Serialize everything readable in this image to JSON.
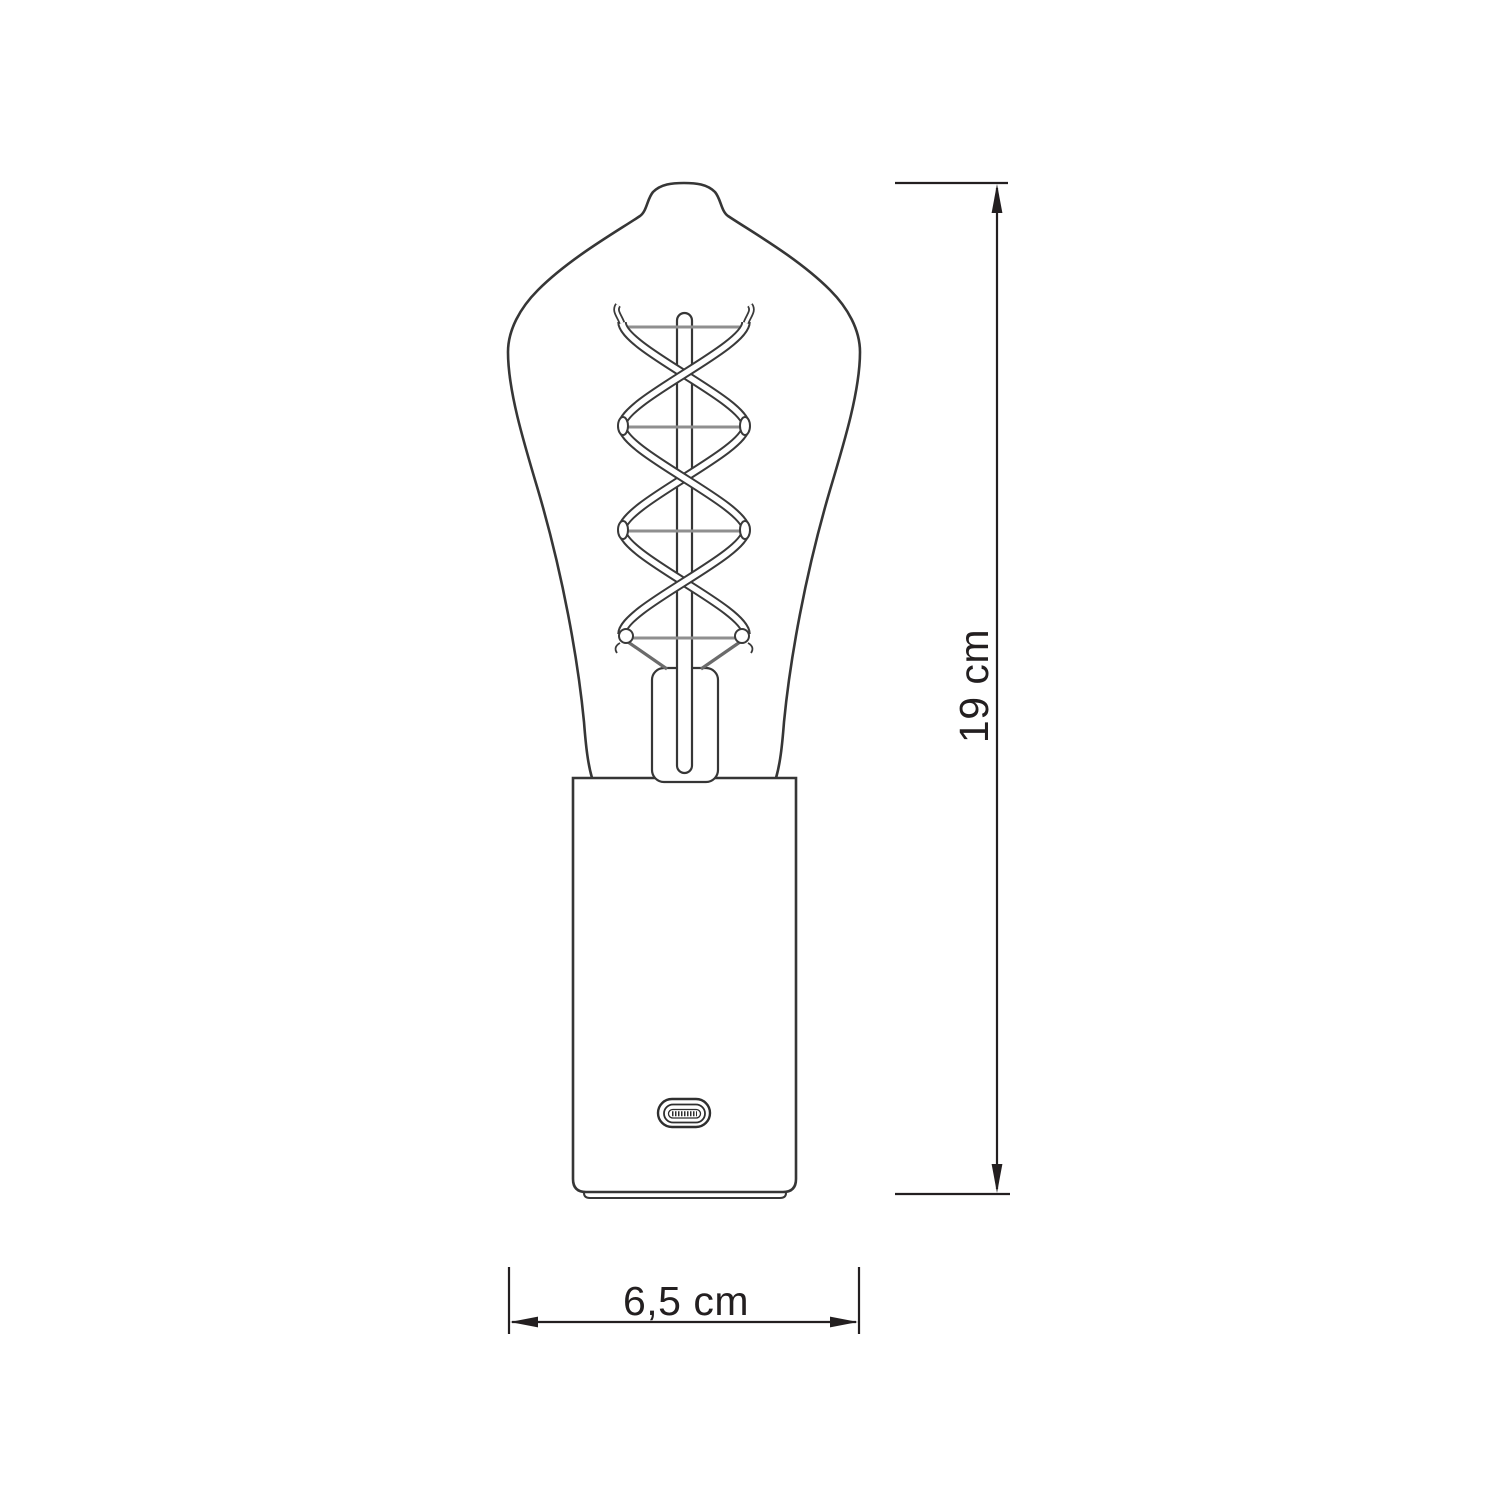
{
  "diagram": {
    "type": "technical-dimension-drawing",
    "subject": "edison-st64-filament-bulb-lamp-with-usb-c-base",
    "dimensions": {
      "height_label": "19 cm",
      "width_label": "6,5 cm"
    },
    "colors": {
      "background": "#ffffff",
      "line": "#363636",
      "filament_outline": "#3a3a3a",
      "support_wire": "#8f8f8f",
      "lead_wire": "#6b6b6b",
      "dimension": "#231f20",
      "text": "#231f20"
    }
  }
}
